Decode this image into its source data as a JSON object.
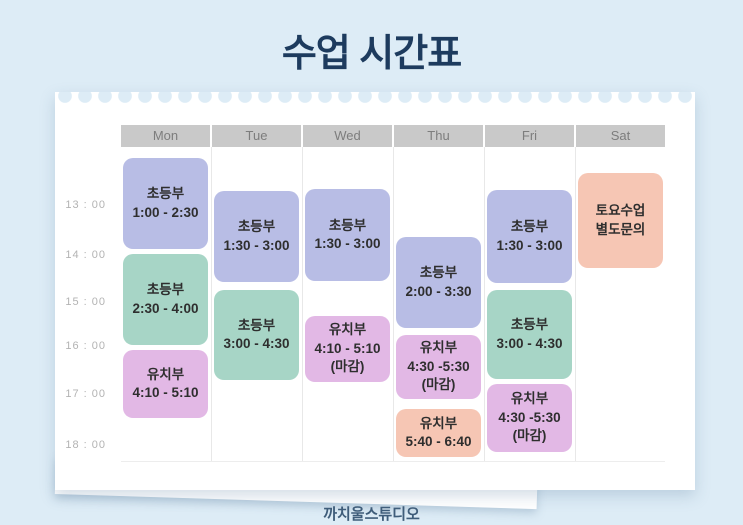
{
  "page": {
    "title": "수업 시간표",
    "footer": "까치울스튜디오"
  },
  "colors": {
    "background": "#ddecf6",
    "card": "#ffffff",
    "title": "#1d3b5e",
    "footer_text": "#3f5d7a",
    "header_bg": "#c9c9c9",
    "header_text": "#7d7d7d",
    "time_text": "#b3b3b3",
    "block_text": "#2e2e2e",
    "separator": "#e8e8e8",
    "lavender": "#b8bde5",
    "mint": "#a7d5c6",
    "orchid": "#e2b8e5",
    "salmon": "#f6c6b4"
  },
  "schedule": {
    "days": [
      "Mon",
      "Tue",
      "Wed",
      "Thu",
      "Fri",
      "Sat"
    ],
    "times": [
      "13 : 00",
      "14 : 00",
      "15 : 00",
      "16 : 00",
      "17 : 00",
      "18 : 00"
    ],
    "blocks": [
      {
        "day": "Mon",
        "col": 0,
        "color": "lavender",
        "lines": [
          "초등부",
          "1:00 - 2:30"
        ],
        "top": 158,
        "height": 91
      },
      {
        "day": "Mon",
        "col": 0,
        "color": "mint",
        "lines": [
          "초등부",
          "2:30 - 4:00"
        ],
        "top": 254,
        "height": 91
      },
      {
        "day": "Mon",
        "col": 0,
        "color": "orchid",
        "lines": [
          "유치부",
          "4:10 - 5:10"
        ],
        "top": 350,
        "height": 68
      },
      {
        "day": "Tue",
        "col": 1,
        "color": "lavender",
        "lines": [
          "초등부",
          "1:30 - 3:00"
        ],
        "top": 191,
        "height": 91
      },
      {
        "day": "Tue",
        "col": 1,
        "color": "mint",
        "lines": [
          "초등부",
          "3:00 - 4:30"
        ],
        "top": 290,
        "height": 90
      },
      {
        "day": "Wed",
        "col": 2,
        "color": "lavender",
        "lines": [
          "초등부",
          "1:30 - 3:00"
        ],
        "top": 189,
        "height": 92
      },
      {
        "day": "Wed",
        "col": 2,
        "color": "orchid",
        "lines": [
          "유치부",
          "4:10 - 5:10",
          "(마감)"
        ],
        "top": 316,
        "height": 66
      },
      {
        "day": "Thu",
        "col": 3,
        "color": "lavender",
        "lines": [
          "초등부",
          "2:00 - 3:30"
        ],
        "top": 237,
        "height": 91
      },
      {
        "day": "Thu",
        "col": 3,
        "color": "orchid",
        "lines": [
          "유치부",
          "4:30 -5:30",
          "(마감)"
        ],
        "top": 335,
        "height": 64
      },
      {
        "day": "Thu",
        "col": 3,
        "color": "salmon",
        "lines": [
          "유치부",
          "5:40 - 6:40"
        ],
        "top": 409,
        "height": 48
      },
      {
        "day": "Fri",
        "col": 4,
        "color": "lavender",
        "lines": [
          "초등부",
          "1:30 - 3:00"
        ],
        "top": 190,
        "height": 93
      },
      {
        "day": "Fri",
        "col": 4,
        "color": "mint",
        "lines": [
          "초등부",
          "3:00 - 4:30"
        ],
        "top": 290,
        "height": 89
      },
      {
        "day": "Fri",
        "col": 4,
        "color": "orchid",
        "lines": [
          "유치부",
          "4:30 -5:30",
          "(마감)"
        ],
        "top": 384,
        "height": 68
      },
      {
        "day": "Sat",
        "col": 5,
        "color": "salmon",
        "lines": [
          "토요수업",
          "별도문의"
        ],
        "top": 173,
        "height": 95
      }
    ]
  }
}
